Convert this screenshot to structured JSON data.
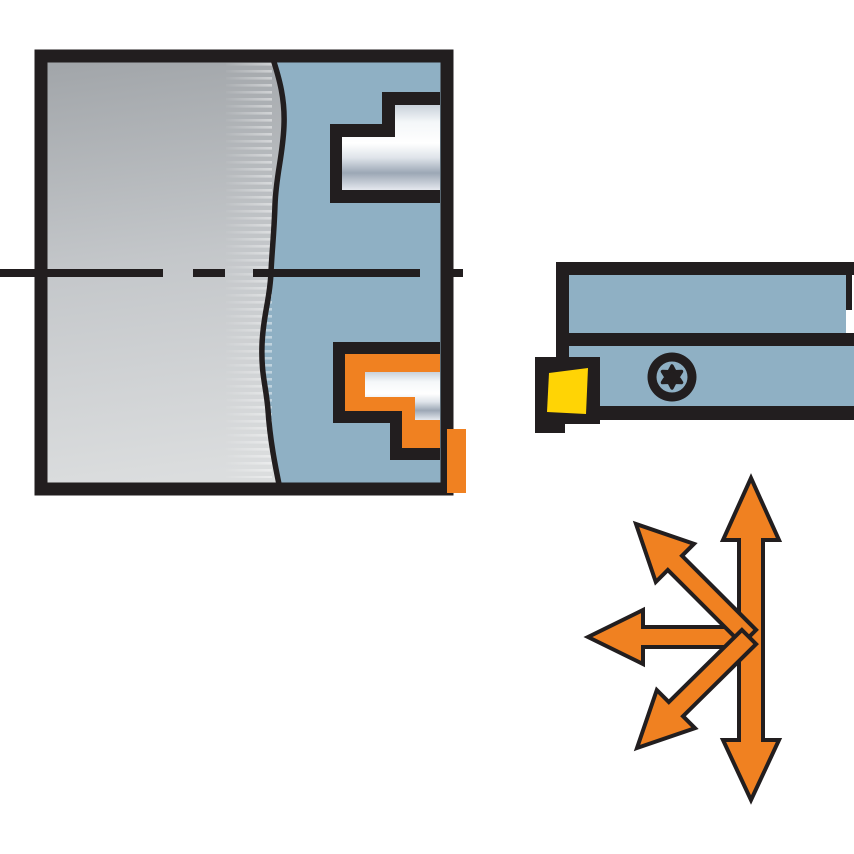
{
  "illustration": {
    "name": "internal-machining-application",
    "parts": {
      "workpiece": "workpiece-cross-section",
      "left_tool": "machining-head-with-insert-pockets",
      "right_tool": "boring-bar-with-insert-and-torx-screw",
      "arrows": "multi-directional-feed-arrows"
    },
    "feed_directions": [
      "up",
      "down",
      "left",
      "up-left",
      "down-left"
    ]
  },
  "colors": {
    "background": "#FFFFFF",
    "outline": "#221E1F",
    "tool_blue": "#8FB0C4",
    "accent_orange": "#F08121",
    "insert_yellow": "#FFD405",
    "gray_top": "#A0A4A8",
    "gray_mid": "#C4C7CA",
    "gray_bottom": "#DBDDDE",
    "steel_edge": "#C9D1DA",
    "steel_bright": "#F4F7F9",
    "steel_highlight": "#FFFFFF",
    "steel_mid": "#DFE4EA",
    "steel_shadow": "#9CA7B5",
    "steel_base": "#E4E8EE"
  }
}
